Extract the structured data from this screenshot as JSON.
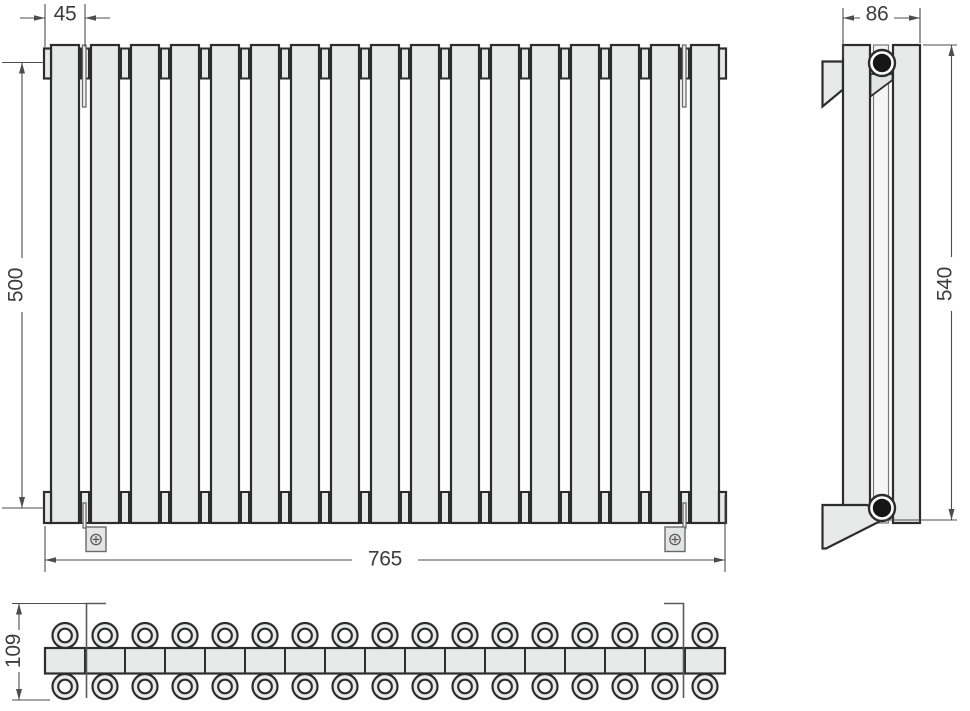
{
  "drawing": {
    "front_view": {
      "sections": 17,
      "dim_section_width": "45",
      "dim_axis_height": "500",
      "dim_total_width": "765"
    },
    "side_view": {
      "dim_depth": "86",
      "dim_total_height": "540"
    },
    "top_view": {
      "tubes_per_row": 17,
      "dim_depth_overall": "109"
    },
    "colors": {
      "body_fill": "#e8e9e9",
      "outline": "#2d2d2d",
      "thin": "#6a6a6a",
      "dimension": "#4d4d4d",
      "text": "#3d3d3d"
    }
  }
}
